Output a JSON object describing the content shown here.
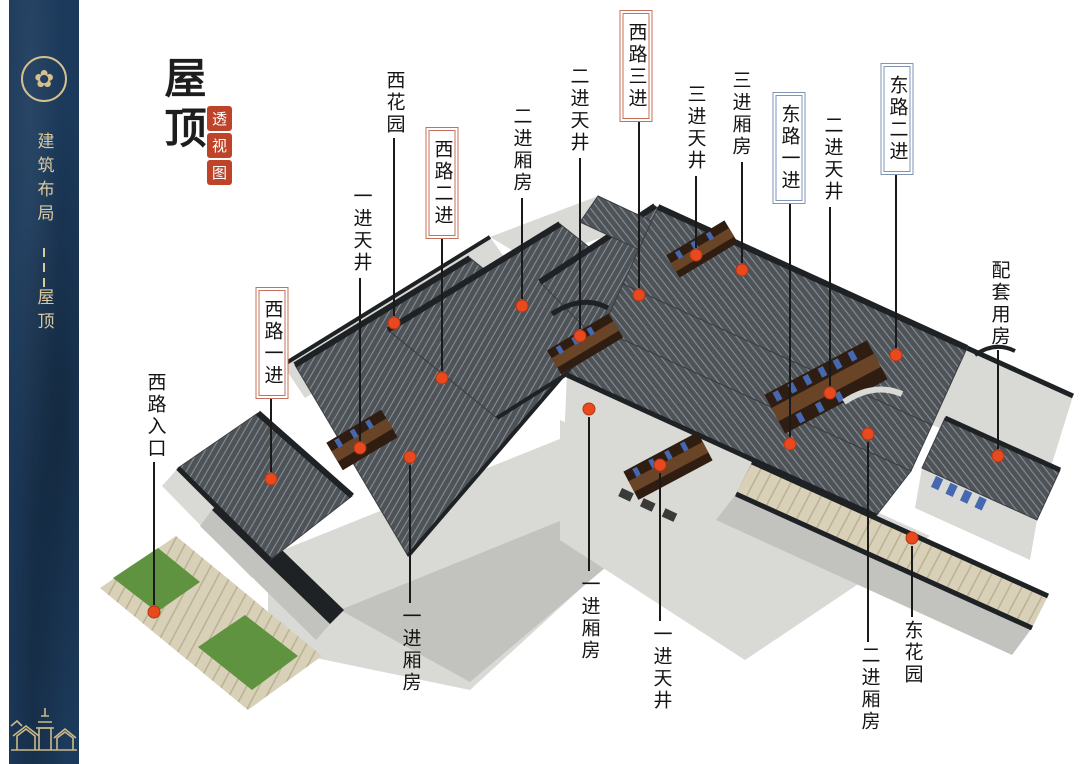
{
  "sidebar": {
    "background": "#1c3a5b",
    "accent": "#d5c08e",
    "emblem_icon": "cloud-medallion",
    "title_vertical": "建筑布局",
    "separator": "---",
    "subtitle_vertical": "屋顶",
    "footer_art": "village-skyline"
  },
  "header": {
    "title": "屋顶",
    "seal": [
      "透",
      "视",
      "图"
    ],
    "seal_color": "#bf4329"
  },
  "diagram": {
    "dot_color": "#e8491f",
    "line_color": "#1a1a1a",
    "west_route_box_color": "#c4705a",
    "east_route_box_color": "#7e95b5",
    "labels": [
      {
        "id": "xihuayuan",
        "text": "西花园",
        "x": 394,
        "top": 70,
        "line_y1": 138,
        "line_y2": 316,
        "dot_x": 394,
        "dot_y": 323,
        "boxed": false,
        "route": "none"
      },
      {
        "id": "yijin-tianjing-w",
        "text": "一进天井",
        "x": 361,
        "top": 186,
        "line_y1": 278,
        "line_y2": 441,
        "dot_x": 360,
        "dot_y": 448,
        "boxed": false,
        "route": "none"
      },
      {
        "id": "xilu-yijin",
        "text": "西路一进",
        "x": 272,
        "top": 290,
        "line_y1": 398,
        "line_y2": 472,
        "dot_x": 271,
        "dot_y": 479,
        "boxed": true,
        "route": "west"
      },
      {
        "id": "xilu-erjin",
        "text": "西路二进",
        "x": 442,
        "top": 130,
        "line_y1": 238,
        "line_y2": 371,
        "dot_x": 442,
        "dot_y": 378,
        "boxed": true,
        "route": "west"
      },
      {
        "id": "erjin-xiangfang-n",
        "text": "二进厢房",
        "x": 521,
        "top": 106,
        "line_y1": 198,
        "line_y2": 299,
        "dot_x": 522,
        "dot_y": 306,
        "boxed": false,
        "route": "none"
      },
      {
        "id": "erjin-tianjing-w",
        "text": "二进天井",
        "x": 578,
        "top": 66,
        "line_y1": 158,
        "line_y2": 329,
        "dot_x": 580,
        "dot_y": 336,
        "boxed": false,
        "route": "none"
      },
      {
        "id": "xilu-sanjin",
        "text": "西路三进",
        "x": 636,
        "top": 13,
        "line_y1": 120,
        "line_y2": 288,
        "dot_x": 639,
        "dot_y": 295,
        "boxed": true,
        "route": "west"
      },
      {
        "id": "sanjin-tianjing",
        "text": "三进天井",
        "x": 695,
        "top": 84,
        "line_y1": 176,
        "line_y2": 248,
        "dot_x": 696,
        "dot_y": 255,
        "boxed": false,
        "route": "none"
      },
      {
        "id": "sanjin-xiangfang",
        "text": "三进厢房",
        "x": 740,
        "top": 70,
        "line_y1": 162,
        "line_y2": 263,
        "dot_x": 742,
        "dot_y": 270,
        "boxed": false,
        "route": "none"
      },
      {
        "id": "donglu-yijin",
        "text": "东路一进",
        "x": 789,
        "top": 95,
        "line_y1": 202,
        "line_y2": 437,
        "dot_x": 790,
        "dot_y": 444,
        "boxed": true,
        "route": "east"
      },
      {
        "id": "erjin-tianjing-e",
        "text": "二进天井",
        "x": 832,
        "top": 115,
        "line_y1": 207,
        "line_y2": 386,
        "dot_x": 830,
        "dot_y": 393,
        "boxed": false,
        "route": "none"
      },
      {
        "id": "donglu-erjin",
        "text": "东路二进",
        "x": 897,
        "top": 66,
        "line_y1": 172,
        "line_y2": 348,
        "dot_x": 896,
        "dot_y": 355,
        "boxed": true,
        "route": "east"
      },
      {
        "id": "peitao-yongfang",
        "text": "配套用房",
        "x": 999,
        "top": 260,
        "line_y1": 350,
        "line_y2": 449,
        "dot_x": 998,
        "dot_y": 456,
        "boxed": false,
        "route": "none"
      },
      {
        "id": "xilu-rukou",
        "text": "西路入口",
        "x": 155,
        "top": 372,
        "line_y1": 462,
        "line_y2": 605,
        "dot_x": 154,
        "dot_y": 612,
        "boxed": false,
        "route": "none"
      },
      {
        "id": "yijin-xiangfang-l",
        "text": "一进厢房",
        "x": 410,
        "top": 606,
        "line_y1": 465,
        "line_y2": 603,
        "dot_x": 410,
        "dot_y": 457,
        "boxed": false,
        "route": "none"
      },
      {
        "id": "yijin-xiangfang-c",
        "text": "一进厢房",
        "x": 589,
        "top": 574,
        "line_y1": 417,
        "line_y2": 571,
        "dot_x": 589,
        "dot_y": 409,
        "boxed": false,
        "route": "none"
      },
      {
        "id": "yijin-tianjing-c",
        "text": "一进天井",
        "x": 661,
        "top": 624,
        "line_y1": 473,
        "line_y2": 621,
        "dot_x": 660,
        "dot_y": 465,
        "boxed": false,
        "route": "none"
      },
      {
        "id": "erjin-xiangfang-s",
        "text": "二进厢房",
        "x": 869,
        "top": 645,
        "line_y1": 442,
        "line_y2": 642,
        "dot_x": 868,
        "dot_y": 434,
        "boxed": false,
        "route": "none"
      },
      {
        "id": "donghuayuan",
        "text": "东花园",
        "x": 912,
        "top": 620,
        "line_y1": 546,
        "line_y2": 617,
        "dot_x": 912,
        "dot_y": 538,
        "boxed": false,
        "route": "none"
      }
    ]
  },
  "scene_colors": {
    "roof": "#4e5358",
    "roofline": "#878d94",
    "ridge": "#1f2225",
    "wall_light": "#d9d9d6",
    "wall_mid": "#c2c2bf",
    "wall_dark": "#9f9f9c",
    "courtyard": "#2e1d10",
    "wood": "#6a4426",
    "window": "#4668b0",
    "pavement": "#d8d1b8",
    "pavement_line": "#b7ae93",
    "grass": "#5f9340",
    "rail": "#7a5a36"
  }
}
